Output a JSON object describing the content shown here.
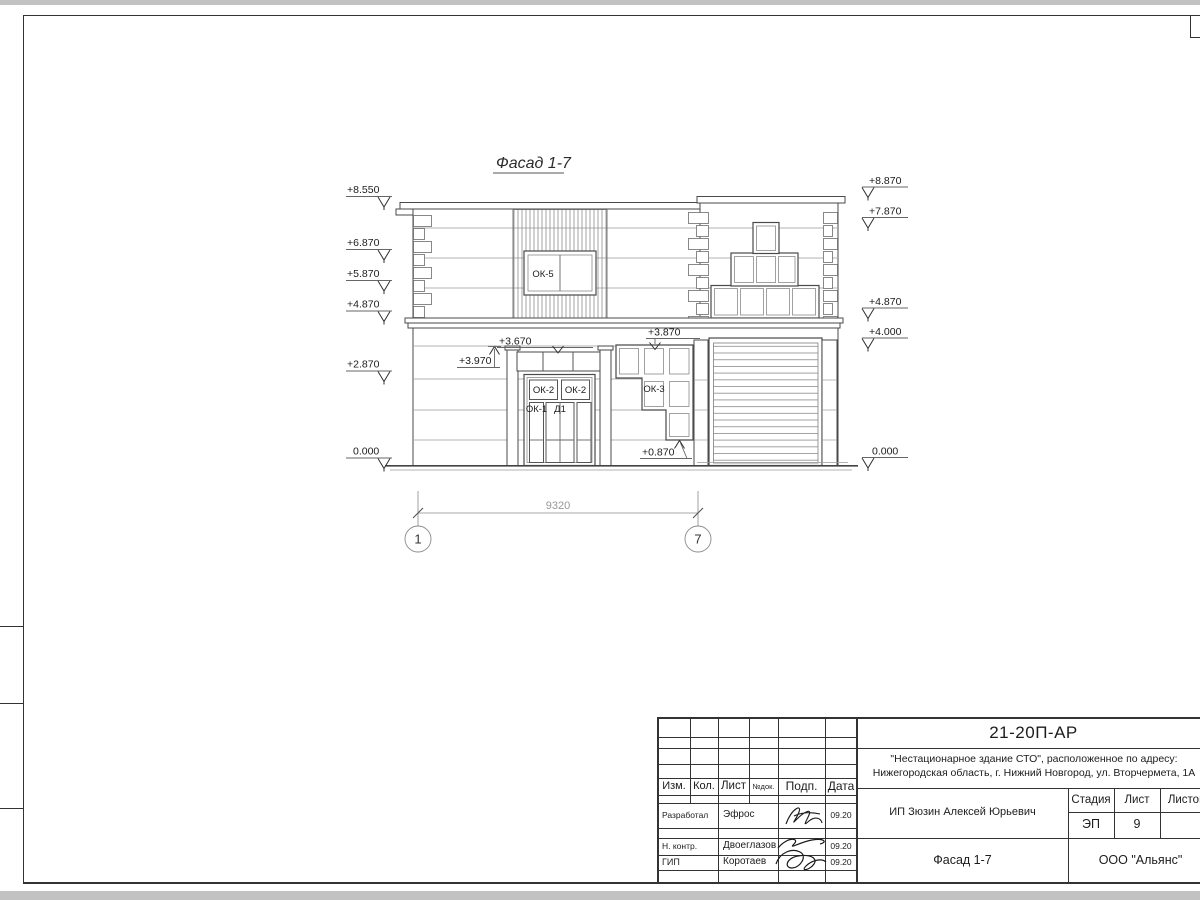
{
  "sheet": {
    "view_title": "Фасад 1-7",
    "dimension_label": "9320",
    "axis_labels": [
      "1",
      "7"
    ],
    "elevation_marks_left": [
      "+8.550",
      "+6.870",
      "+5.870",
      "+4.870",
      "+2.870",
      "0.000"
    ],
    "elevation_marks_right": [
      "+8.870",
      "+7.870",
      "+4.870",
      "+4.000",
      "0.000"
    ],
    "detail_marks": {
      "pilaster_top": "+3.970",
      "entrance_transom": "+3.670",
      "window_top": "+3.870",
      "window_bottom": "+0.870"
    },
    "window_labels": {
      "ok5": "ОК-5",
      "ok2_left": "ОК-2",
      "ok2_right": "ОК-2",
      "ok3": "ОК-3",
      "ok1": "ОК-1",
      "door": "Д1"
    }
  },
  "title_block": {
    "doc_number": "21-20П-АР",
    "project_name_line1": "\"Нестационарное здание СТО\", расположенное по адресу:",
    "project_name_line2": "Нижегородская область, г. Нижний Новгород, ул. Вторчермета, 1А",
    "change_table_headers": [
      "Изм.",
      "Кол.",
      "Лист",
      "№док.",
      "Подп.",
      "Дата"
    ],
    "signature_rows": [
      {
        "role": "Разработал",
        "name": "Эфрос",
        "date": "09.20"
      },
      {
        "role": "Н. контр.",
        "name": "Двоеглазов",
        "date": "09.20"
      },
      {
        "role": "ГИП",
        "name": "Коротаев",
        "date": "09.20"
      }
    ],
    "client": "ИП Зюзин Алексей Юрьевич",
    "stage_header": "Стадия",
    "sheet_header": "Лист",
    "sheets_header": "Листов",
    "stage_value": "ЭП",
    "sheet_value": "9",
    "drawing_title": "Фасад 1-7",
    "company": "ООО \"Альянс\""
  }
}
